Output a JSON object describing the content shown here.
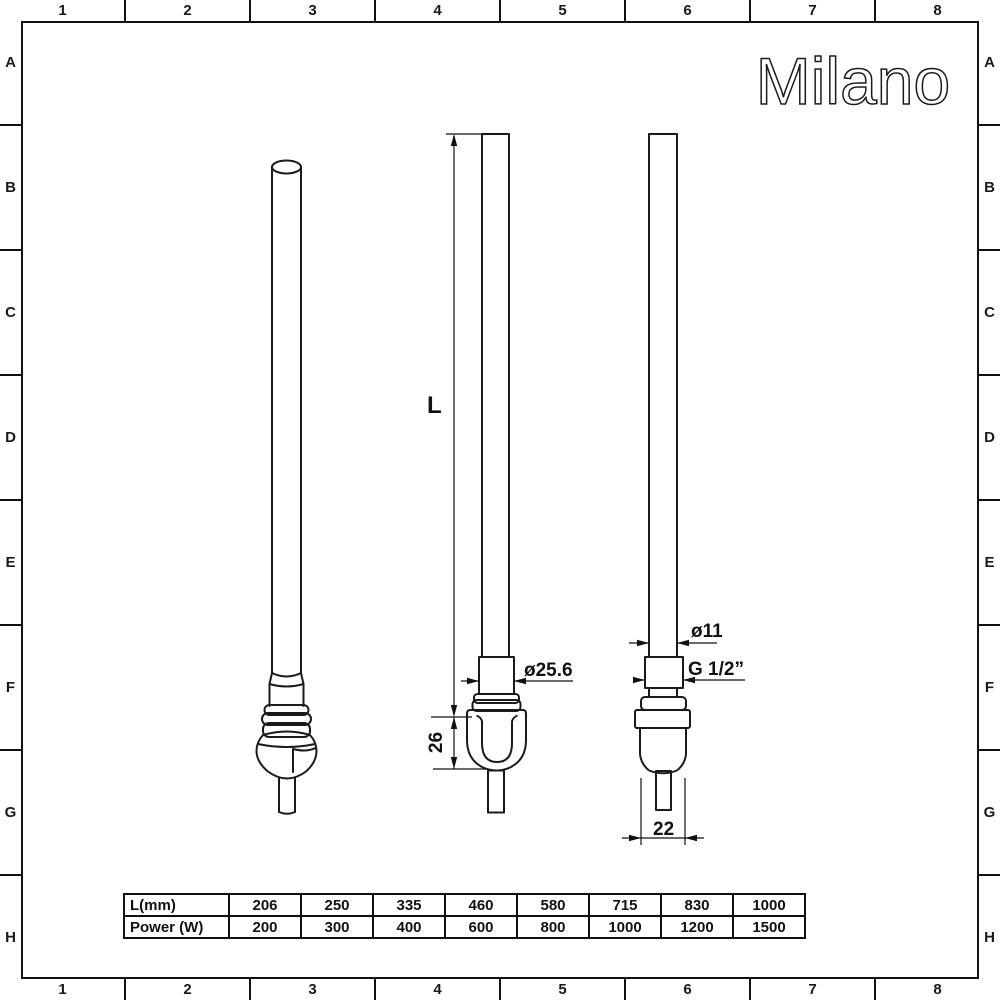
{
  "logo": {
    "text": "Milano"
  },
  "grid": {
    "columns": [
      "1",
      "2",
      "3",
      "4",
      "5",
      "6",
      "7",
      "8"
    ],
    "rows": [
      "A",
      "B",
      "C",
      "D",
      "E",
      "F",
      "G",
      "H"
    ]
  },
  "dimensions": {
    "length_label": "L",
    "element_diameter": "ø25.6",
    "body_height": "26",
    "tube_diameter": "ø11",
    "thread_size": "G 1/2”",
    "body_width": "22"
  },
  "spec_table": {
    "rows": [
      {
        "label": "L(mm)",
        "values": [
          "206",
          "250",
          "335",
          "460",
          "580",
          "715",
          "830",
          "1000"
        ]
      },
      {
        "label": "Power (W)",
        "values": [
          "200",
          "300",
          "400",
          "600",
          "800",
          "1000",
          "1200",
          "1500"
        ]
      }
    ]
  }
}
